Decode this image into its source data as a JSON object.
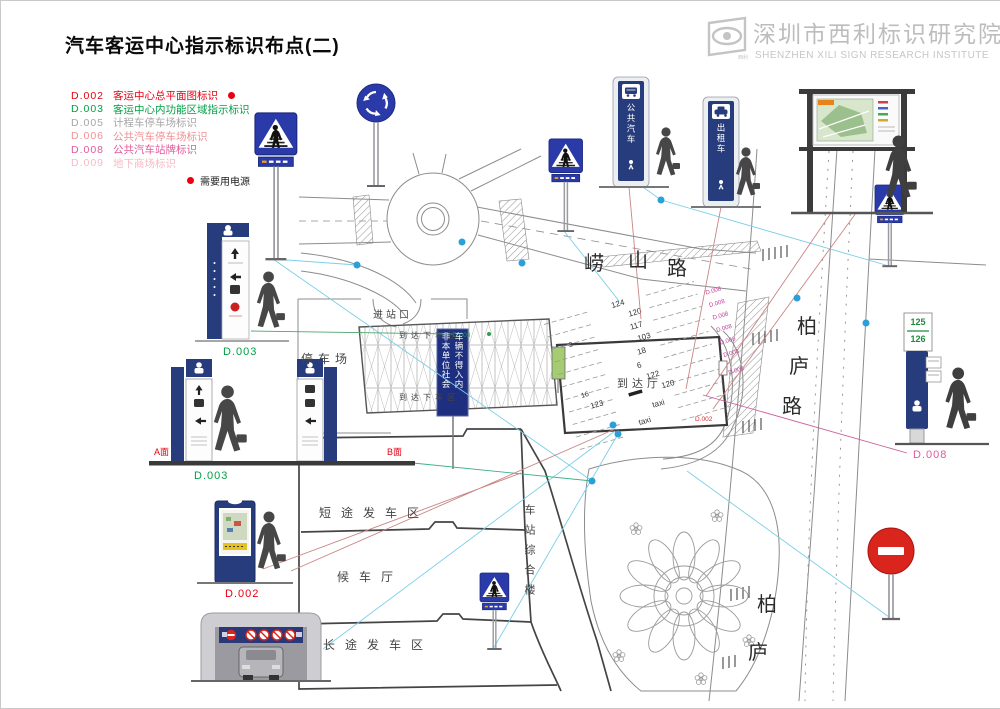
{
  "page": {
    "title": "汽车客运中心指示标识布点(二)"
  },
  "brand": {
    "cn": "深圳市西利标识研究院",
    "en": "SHENZHEN XILI SIGN RESEARCH INSTITUTE",
    "logo_caption": "西利"
  },
  "legend": {
    "items": [
      {
        "code": "D.002",
        "label": "客运中心总平面图标识",
        "color": "#e60012",
        "powered": true
      },
      {
        "code": "D.003",
        "label": "客运中心内功能区域指示标识",
        "color": "#00a044"
      },
      {
        "code": "D.005",
        "label": "计程车停车场标识",
        "color": "#a6a6a6"
      },
      {
        "code": "D.006",
        "label": "公共汽车停车场标识",
        "color": "#f19093"
      },
      {
        "code": "D.008",
        "label": "公共汽车站牌标识",
        "color": "#e05a9b"
      },
      {
        "code": "D.009",
        "label": "地下商场标识",
        "color": "#f6bac6"
      }
    ],
    "power_note": "需要用电源",
    "power_color": "#e60012"
  },
  "map": {
    "roads": {
      "laoshan": [
        "崂",
        "山",
        "路"
      ],
      "bailu": [
        "柏",
        "庐",
        "路"
      ],
      "bailu2": [
        "柏",
        "庐"
      ]
    },
    "labels": {
      "entrance": "进站口",
      "parking": "停车场",
      "dropoff_top": "到达下车区",
      "dropoff_bottom": "到达下车区",
      "arrival_hall": "到达厅",
      "short_depart": "短途发车区",
      "waiting_hall": "候车厅",
      "long_depart": "长途发车区",
      "station_complex": "车站综合楼",
      "notice_col1": "非本单位社会",
      "notice_col2": "车辆不得入内"
    },
    "bays": [
      "124",
      "120",
      "117",
      "3",
      "103",
      "18",
      "6",
      "16",
      "122",
      "123",
      "120",
      "taxi",
      "taxi"
    ],
    "markers": {
      "d008": "D.008",
      "d003": "D.003",
      "d002": "D.002"
    }
  },
  "signs": {
    "bus_pylon": "公共汽车",
    "taxi_pylon": "出租车",
    "routes": [
      "125",
      "126"
    ],
    "labels": {
      "d003_1": "D.003",
      "d003_2": "D.003",
      "d002": "D.002",
      "d008": "D.008",
      "side_a": "A面",
      "side_b": "B面"
    },
    "label_colors": {
      "green": "#00a044",
      "red": "#e60012",
      "magenta": "#e05a9b"
    }
  }
}
